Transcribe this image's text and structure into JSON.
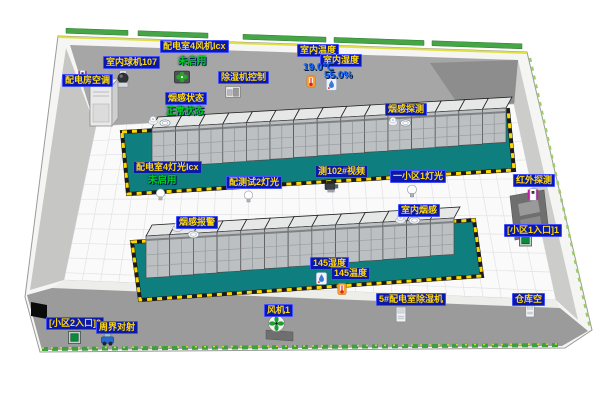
{
  "scene_type": "3d-room-monitoring-view",
  "labels": {
    "fan4": "配电室4风机Icx",
    "fan4_status": "未启用",
    "dome_camera": "室内球机107",
    "room_ac": "配电房空调",
    "dehum_control": "除湿机控制",
    "smoke_status": "烟感状态",
    "smoke_status_value": "正常状态",
    "indoor_temp": "室内温度",
    "indoor_temp_value": "19.0℃",
    "indoor_hum": "室内湿度",
    "indoor_hum_value": "55.0%",
    "smoke_detect": "烟感探测",
    "light4": "配电室4灯光Icx",
    "light4_status": "未启用",
    "light_test2": "配测试2灯光",
    "video102": "测102#视频",
    "zone1_light": "一小区1灯光",
    "indoor_smoke": "室内烟感",
    "smoke_alarm": "烟感报警",
    "infrared": "红外探测",
    "zone1_door": "[小区1入口]1",
    "hum145": "145湿度",
    "temp145": "145温度",
    "dehum5": "5#配电室除湿机",
    "fan1": "风机1",
    "warehouse": "仓库空",
    "zone2_door": "[小区2入口]2",
    "perimeter": "周界对射"
  },
  "icons": {
    "light_bulb": "bulb",
    "exhaust_fan": "fan-dark-square",
    "green_fan": "fan-green-round",
    "dome_camera": "ball-camera",
    "ptz_camera": "video-camera",
    "thermometer": "orange-thermometer",
    "humidity": "blue-droplet-meter",
    "smoke_detector": "white-dome",
    "smoke_ring": "white-ring",
    "infrared_sensor": "white-magenta-box",
    "door_contact": "green-square",
    "perimeter_beam": "blue-cart",
    "device_box": "white-cabinet"
  },
  "colors": {
    "chip_bg": "#0a18ac",
    "chip_text": "#ffd900",
    "status_green": "#00cc22",
    "value_blue": "#1266ff",
    "platform_teal": "#0e7e7e",
    "hazard_yellow": "#ffd700",
    "wall_gray": "#a6a6a6",
    "floor_white": "#fafafa",
    "hedge_green": "#3f9f3f"
  }
}
